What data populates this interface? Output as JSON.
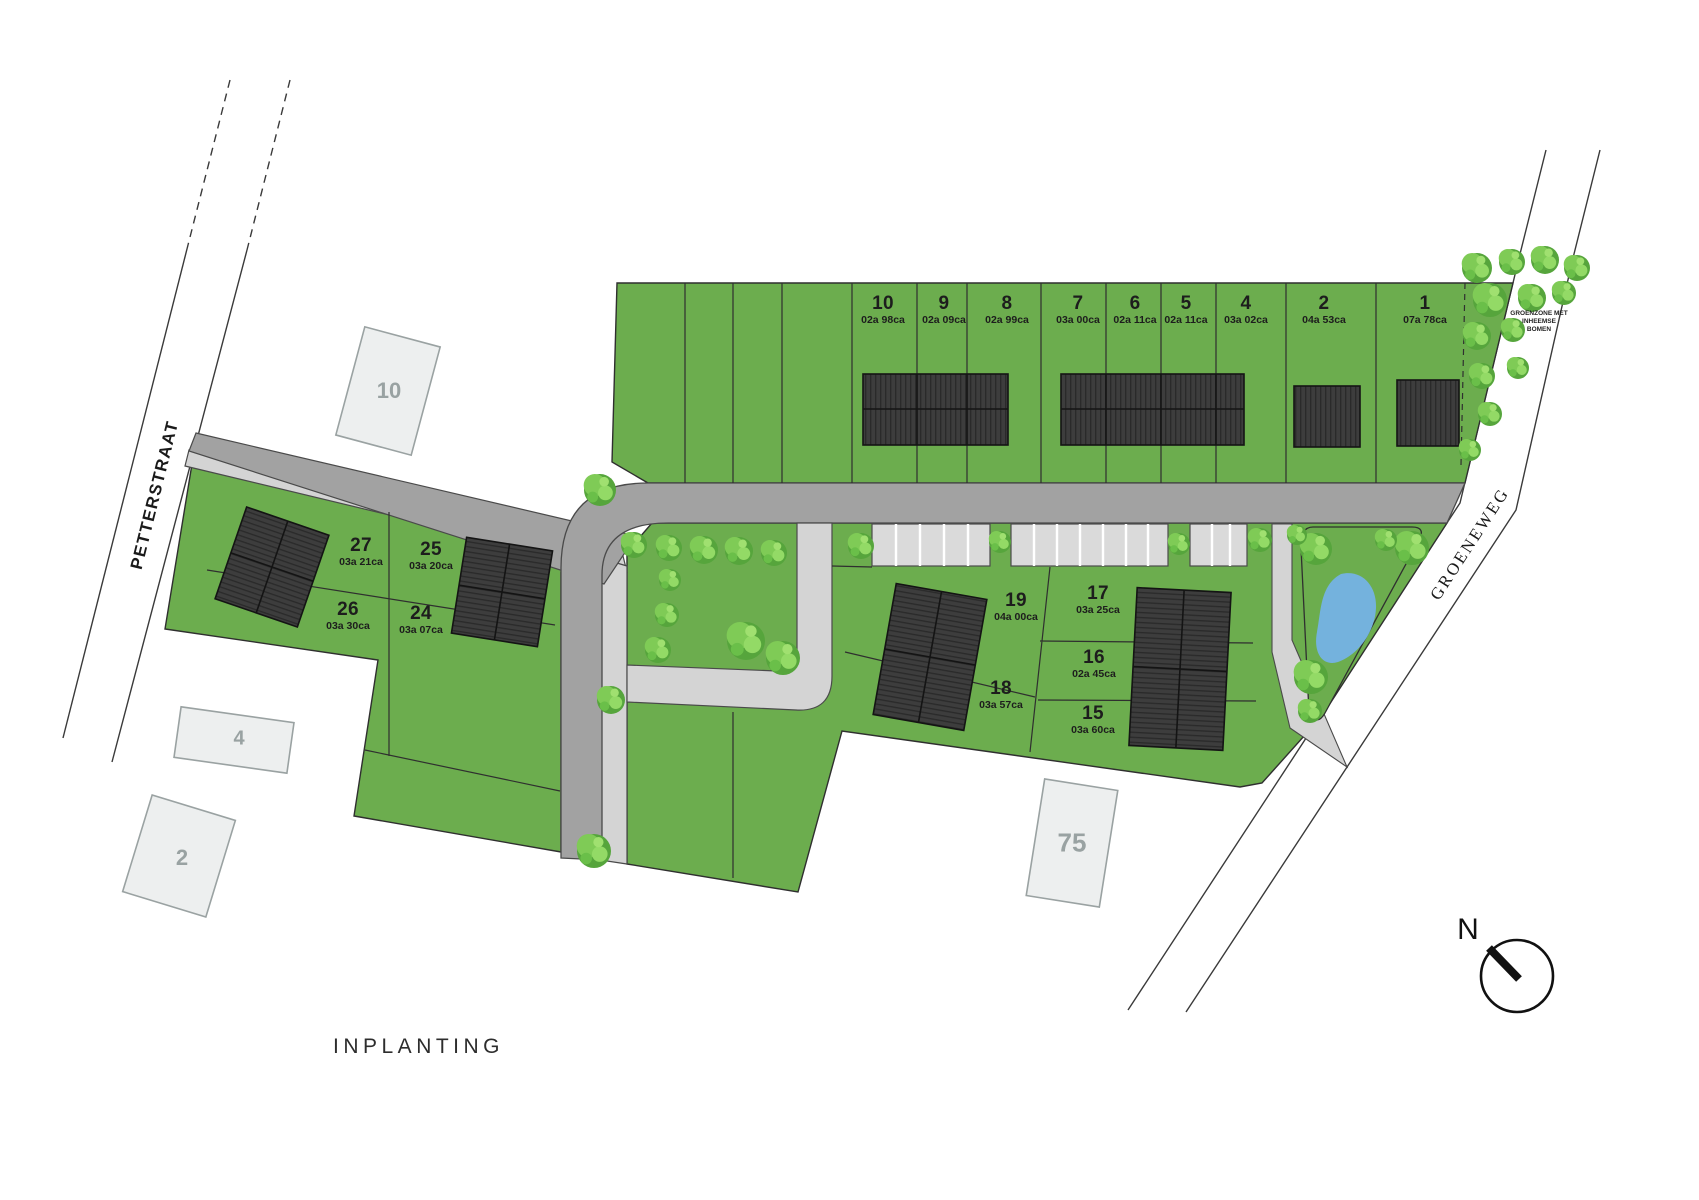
{
  "title": "INPLANTING",
  "compass": {
    "label": "N"
  },
  "streets": {
    "petterstraat": "PETTERSTRAAT",
    "groeneweg": "GROENEWEG"
  },
  "greenzone": {
    "note": "GROENZONE MET INHEEMSE\nBOMEN"
  },
  "lots": [
    {
      "number": "10",
      "area": "02a 98ca"
    },
    {
      "number": "9",
      "area": "02a 09ca"
    },
    {
      "number": "8",
      "area": "02a 99ca"
    },
    {
      "number": "7",
      "area": "03a 00ca"
    },
    {
      "number": "6",
      "area": "02a 11ca"
    },
    {
      "number": "5",
      "area": "02a 11ca"
    },
    {
      "number": "4",
      "area": "03a 02ca"
    },
    {
      "number": "2",
      "area": "04a 53ca"
    },
    {
      "number": "1",
      "area": "07a 78ca"
    },
    {
      "number": "27",
      "area": "03a 21ca"
    },
    {
      "number": "25",
      "area": "03a 20ca"
    },
    {
      "number": "26",
      "area": "03a 30ca"
    },
    {
      "number": "24",
      "area": "03a 07ca"
    },
    {
      "number": "19",
      "area": "04a 00ca"
    },
    {
      "number": "17",
      "area": "03a 25ca"
    },
    {
      "number": "18",
      "area": "03a 57ca"
    },
    {
      "number": "16",
      "area": "02a 45ca"
    },
    {
      "number": "15",
      "area": "03a 60ca"
    }
  ],
  "existing_buildings": [
    {
      "label": "10"
    },
    {
      "label": "4"
    },
    {
      "label": "2"
    },
    {
      "label": "75"
    }
  ],
  "colors": {
    "parcel_green": "#6cad4e",
    "tree_green": "#7fcb56",
    "road_gray": "#a2a2a2",
    "sidewalk_gray": "#d4d4d4",
    "parking_gray": "#dadada",
    "building_dark": "#3d3d3d",
    "existing_building_fill": "#edefef",
    "pond_blue": "#74b2dd"
  }
}
